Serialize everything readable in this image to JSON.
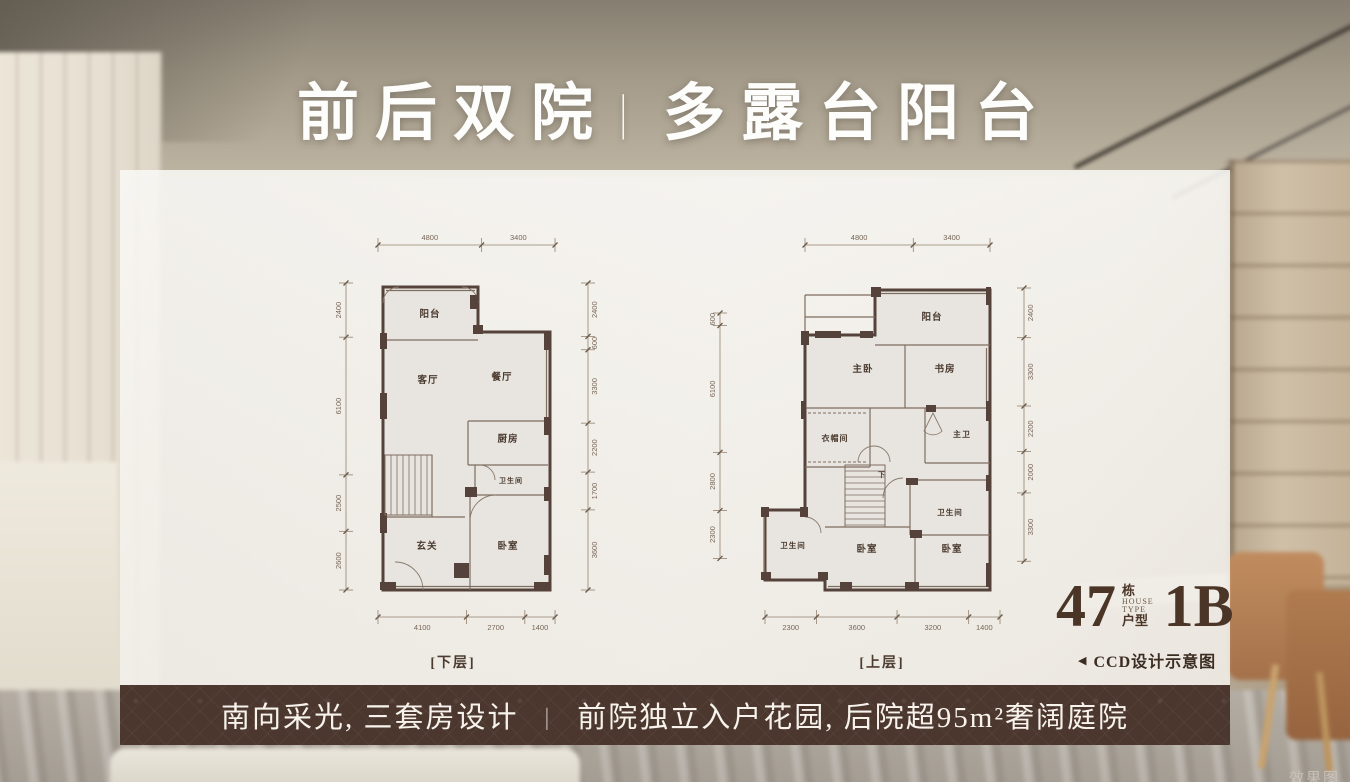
{
  "title": {
    "part1": "前后双院",
    "separator": "|",
    "part2": "多露台阳台"
  },
  "plans": [
    {
      "caption": "[下层]",
      "dims": {
        "top": [
          "4800",
          "3400"
        ],
        "left": [
          "2400",
          "6100",
          "2500",
          "2600"
        ],
        "right": [
          "2400",
          "600",
          "3300",
          "2200",
          "1700",
          "3600"
        ],
        "bottom": [
          "4100",
          "2700",
          "1400"
        ]
      },
      "rooms": [
        "阳台",
        "客厅",
        "餐厅",
        "厨房",
        "卫生间",
        "玄关",
        "卧室"
      ]
    },
    {
      "caption": "[上层]",
      "dims": {
        "top": [
          "4800",
          "3400"
        ],
        "left": [
          "600",
          "6100",
          "2800",
          "2300"
        ],
        "right": [
          "2400",
          "3300",
          "2200",
          "2000",
          "3300"
        ],
        "bottom": [
          "2300",
          "3600",
          "3200",
          "1400"
        ]
      },
      "rooms": [
        "阳台",
        "主卧",
        "书房",
        "衣帽间",
        "主卫",
        "卫生间",
        "卫生间",
        "卧室",
        "卧室",
        "下"
      ]
    }
  ],
  "unit": {
    "building_number": "47",
    "building_suffix": "栋",
    "house_en_1": "HOUSE",
    "house_en_2": "TYPE",
    "house_cn": "户型",
    "unit_type": "1B"
  },
  "design_note": {
    "arrow": "◀",
    "text": "CCD设计示意图"
  },
  "banner": {
    "left": "南向采光, 三套房设计",
    "separator": "|",
    "right": "前院独立入户花园, 后院超95m²奢阔庭院"
  },
  "watermark": "效果图",
  "colors": {
    "banner_bg": "#4b372e",
    "accent_brown": "#4a3527",
    "wall": "#55423a",
    "inner_line": "#7e6d5f",
    "dim_line": "#93836f",
    "dim_text": "#776657",
    "room_text": "#4a3a2e",
    "plan_fill": "#e7e4df"
  }
}
